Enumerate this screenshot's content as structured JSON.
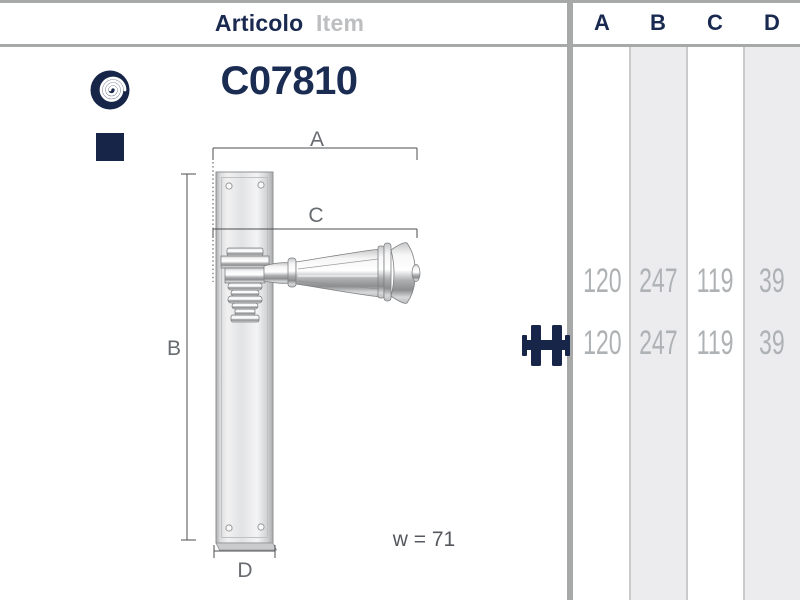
{
  "header": {
    "articolo": "Articolo",
    "item": "Item",
    "columns": [
      "A",
      "B",
      "C",
      "D"
    ]
  },
  "product": {
    "code": "C07810"
  },
  "drawing": {
    "dim_a": "A",
    "dim_b": "B",
    "dim_c": "C",
    "dim_d": "D",
    "width_note": "w = 71"
  },
  "table": {
    "rows": [
      {
        "values": [
          "120",
          "247",
          "119",
          "39"
        ]
      },
      {
        "values": [
          "120",
          "247",
          "119",
          "39"
        ]
      }
    ]
  },
  "icons": {
    "spiral": "brand-spiral-icon",
    "square": "finish-square-icon",
    "handle_pair": "handle-pair-icon"
  },
  "colors": {
    "navy": "#192950",
    "value_gray": "#afb2b4",
    "column_shade": "#ececee",
    "frame_gray": "#a7a9a9"
  }
}
